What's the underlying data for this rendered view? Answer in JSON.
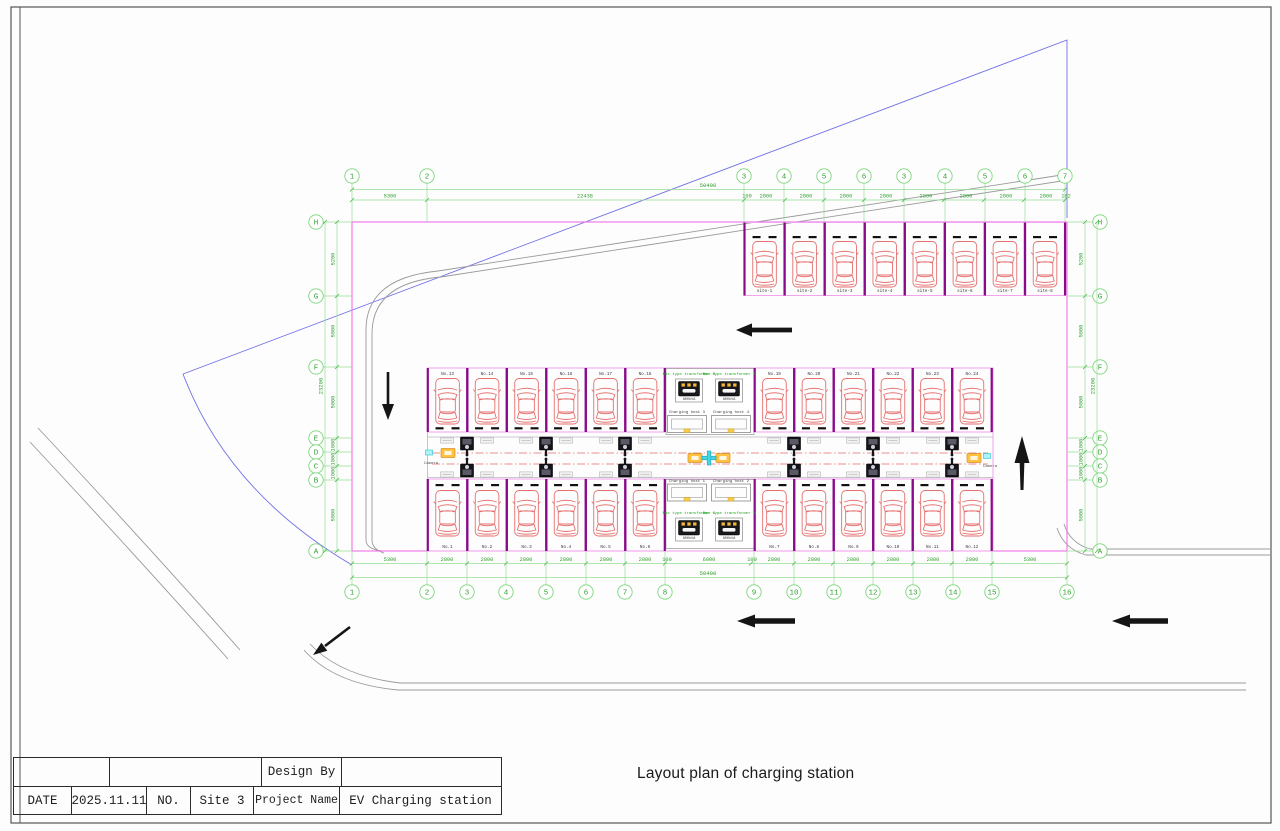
{
  "page": {
    "drawing_title": "Layout plan of charging station"
  },
  "title_block": {
    "design_by_label": "Design By",
    "date_label": "DATE",
    "date_value": "2025.11.11",
    "no_label": "NO.",
    "site_value": "Site 3",
    "project_label": "Project Name",
    "project_value": "EV Charging station"
  },
  "grid": {
    "top_columns": [
      {
        "label": "1",
        "x": 352
      },
      {
        "label": "2",
        "x": 427
      },
      {
        "label": "3",
        "x": 744
      },
      {
        "label": "4",
        "x": 784
      },
      {
        "label": "5",
        "x": 824
      },
      {
        "label": "6",
        "x": 864
      },
      {
        "label": "3",
        "x": 904
      },
      {
        "label": "4",
        "x": 945
      },
      {
        "label": "5",
        "x": 985
      },
      {
        "label": "6",
        "x": 1025
      },
      {
        "label": "7",
        "x": 1065
      }
    ],
    "bottom_columns": [
      {
        "label": "1",
        "x": 352
      },
      {
        "label": "2",
        "x": 427
      },
      {
        "label": "3",
        "x": 467
      },
      {
        "label": "4",
        "x": 506
      },
      {
        "label": "5",
        "x": 546
      },
      {
        "label": "6",
        "x": 586
      },
      {
        "label": "7",
        "x": 625
      },
      {
        "label": "8",
        "x": 665
      },
      {
        "label": "9",
        "x": 754
      },
      {
        "label": "10",
        "x": 794
      },
      {
        "label": "11",
        "x": 834
      },
      {
        "label": "12",
        "x": 873
      },
      {
        "label": "13",
        "x": 913
      },
      {
        "label": "14",
        "x": 953
      },
      {
        "label": "15",
        "x": 992
      },
      {
        "label": "16",
        "x": 1067
      }
    ],
    "left_rows": [
      {
        "label": "H",
        "y": 222
      },
      {
        "label": "G",
        "y": 296
      },
      {
        "label": "F",
        "y": 367
      },
      {
        "label": "E",
        "y": 438
      },
      {
        "label": "D",
        "y": 452
      },
      {
        "label": "C",
        "y": 466
      },
      {
        "label": "B",
        "y": 480
      },
      {
        "label": "A",
        "y": 551
      }
    ],
    "right_rows": [
      {
        "label": "H",
        "y": 222
      },
      {
        "label": "G",
        "y": 296
      },
      {
        "label": "F",
        "y": 367
      },
      {
        "label": "E",
        "y": 438
      },
      {
        "label": "D",
        "y": 452
      },
      {
        "label": "C",
        "y": 466
      },
      {
        "label": "B",
        "y": 480
      },
      {
        "label": "A",
        "y": 551
      }
    ]
  },
  "dimensions": {
    "top_total": "50400",
    "bottom_total": "50400",
    "side_total": "23200",
    "top": [
      {
        "t": "5300",
        "x": 390
      },
      {
        "t": "22438",
        "x": 585
      },
      {
        "t": "100",
        "x": 747
      },
      {
        "t": "2800",
        "x": 766
      },
      {
        "t": "2800",
        "x": 806
      },
      {
        "t": "2800",
        "x": 846
      },
      {
        "t": "2800",
        "x": 886
      },
      {
        "t": "2800",
        "x": 926
      },
      {
        "t": "2800",
        "x": 966
      },
      {
        "t": "2800",
        "x": 1006
      },
      {
        "t": "2800",
        "x": 1046
      },
      {
        "t": "162",
        "x": 1066
      }
    ],
    "bottom": [
      {
        "t": "5300",
        "x": 390
      },
      {
        "t": "2800",
        "x": 447
      },
      {
        "t": "2800",
        "x": 487
      },
      {
        "t": "2800",
        "x": 526
      },
      {
        "t": "2800",
        "x": 566
      },
      {
        "t": "2800",
        "x": 606
      },
      {
        "t": "2800",
        "x": 645
      },
      {
        "t": "100",
        "x": 667
      },
      {
        "t": "6000",
        "x": 709
      },
      {
        "t": "100",
        "x": 752
      },
      {
        "t": "2800",
        "x": 774
      },
      {
        "t": "2800",
        "x": 814
      },
      {
        "t": "2800",
        "x": 853
      },
      {
        "t": "2800",
        "x": 893
      },
      {
        "t": "2800",
        "x": 933
      },
      {
        "t": "2800",
        "x": 972
      },
      {
        "t": "5300",
        "x": 1030
      }
    ],
    "side": [
      {
        "t": "5200",
        "y": 259
      },
      {
        "t": "5000",
        "y": 331
      },
      {
        "t": "5000",
        "y": 402
      },
      {
        "t": "1000",
        "y": 445
      },
      {
        "t": "1000",
        "y": 459
      },
      {
        "t": "1000",
        "y": 473
      },
      {
        "t": "5000",
        "y": 515
      }
    ]
  },
  "stalls": {
    "site_row": [
      "site-1",
      "site-2",
      "site-3",
      "site-4",
      "site-5",
      "site-6",
      "site-7",
      "site-8"
    ],
    "upper_row": [
      "No.13",
      "No.14",
      "No.15",
      "No.16",
      "No.17",
      "No.18",
      "No.19",
      "No.20",
      "No.21",
      "No.22",
      "No.23",
      "No.24"
    ],
    "lower_row": [
      "No.1",
      "No.2",
      "No.3",
      "No.4",
      "No.5",
      "No.6",
      "No.7",
      "No.8",
      "No.9",
      "No.10",
      "No.11",
      "No.12"
    ]
  },
  "equipment": {
    "transformers": [
      {
        "label": "Box type transformer 3",
        "rating": "800kVA",
        "x": 689,
        "label_y": 375,
        "y": 390
      },
      {
        "label": "Box type transformer 4",
        "rating": "800kVA",
        "x": 729,
        "label_y": 375,
        "y": 390
      },
      {
        "label": "Box type transformer 1",
        "rating": "800kVA",
        "x": 689,
        "label_y": 514,
        "y": 529
      },
      {
        "label": "Box type transformer 2",
        "rating": "800kVA",
        "x": 729,
        "label_y": 514,
        "y": 529
      }
    ],
    "hosts": [
      {
        "label": "Charging host 3",
        "x": 687,
        "label_y": 413,
        "y": 424
      },
      {
        "label": "Charging host 4",
        "x": 731,
        "label_y": 413,
        "y": 424
      },
      {
        "label": "Charging host 1",
        "x": 687,
        "label_y": 482,
        "y": 492.5
      },
      {
        "label": "Charging host 2",
        "x": 731,
        "label_y": 482,
        "y": 492.5
      }
    ],
    "cameras": [
      {
        "label": "Camera",
        "icon_x": 429,
        "icon_y": 452.5,
        "text_x": 431,
        "text_y": 464
      },
      {
        "label": "Camera",
        "icon_x": 987,
        "icon_y": 456,
        "text_x": 990,
        "text_y": 467
      }
    ]
  },
  "colors": {
    "grid_green": "#2e9e2e",
    "boundary_pink": "#ef6fe8",
    "stall_purple": "#8a0b8a",
    "car_red": "#e5716f",
    "road_grey": "#9a9a9a",
    "parcel_blue": "#7070e8",
    "marker_orange": "#ffc23e",
    "marker_cyan": "#49d6e4"
  }
}
